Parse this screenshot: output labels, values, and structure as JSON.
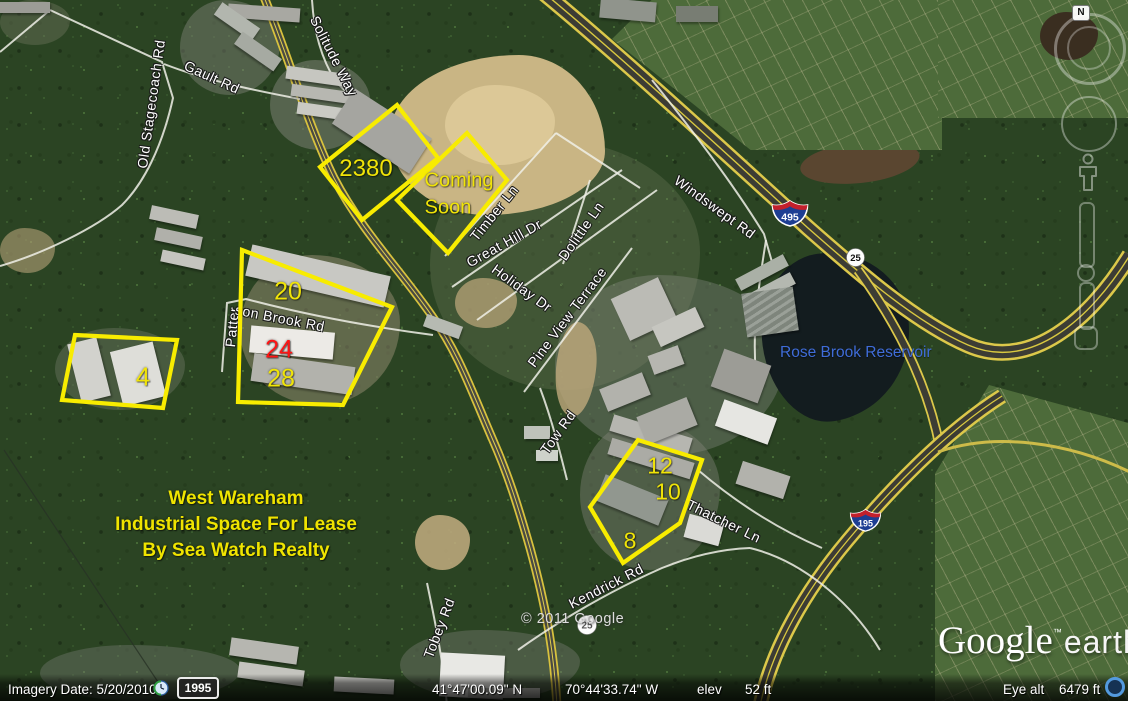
{
  "map": {
    "attribution": "© 2011 Google",
    "logo": {
      "brand": "Google",
      "tm": "™",
      "product": "earth"
    }
  },
  "annotations": {
    "parcels": [
      {
        "label": "2380"
      },
      {
        "line1": "Coming",
        "line2": "Soon"
      },
      {
        "label": "20"
      },
      {
        "label": "24"
      },
      {
        "label": "28"
      },
      {
        "label": "4"
      },
      {
        "label": "12"
      },
      {
        "label": "10"
      },
      {
        "label": "8"
      }
    ],
    "promo": {
      "line1": "West Wareham",
      "line2": "Industrial Space For Lease",
      "line3": "By Sea Watch Realty"
    },
    "outline_color": "#f8ec00",
    "highlight_color": "#ff1414"
  },
  "roads": {
    "old_stagecoach": "Old Stagecoach Rd",
    "gault": "Gault Rd",
    "solitude": "Solitude Way",
    "timber": "Timber Ln",
    "great_hill": "Great Hill Dr",
    "holiday": "Holiday Dr",
    "dolittle": "Dolittle Ln",
    "windswept": "Windswept Rd",
    "pine_view": "Pine View Terrace",
    "patterson_part1": "Patter",
    "patterson_part2": "son Brook Rd",
    "tow": "Tow Rd",
    "thatcher": "Thatcher Ln",
    "kendrick": "Kendrick Rd",
    "tobey": "Tobey Rd"
  },
  "shields": {
    "i495": "495",
    "i195": "195",
    "route25": "25",
    "route25_south": "25"
  },
  "water": {
    "reservoir": "Rose Brook Reservoir",
    "label_color": "#3f6cd8"
  },
  "navigation": {
    "north": "N"
  },
  "status_bar": {
    "imagery": "Imagery Date: 5/20/2010",
    "time_badge": "1995",
    "latitude": "41°47'00.09\" N",
    "longitude": "70°44'33.74\" W",
    "elev_label": "elev",
    "elev_value": "52 ft",
    "eye_alt_label": "Eye alt",
    "eye_alt_value": "6479 ft"
  }
}
